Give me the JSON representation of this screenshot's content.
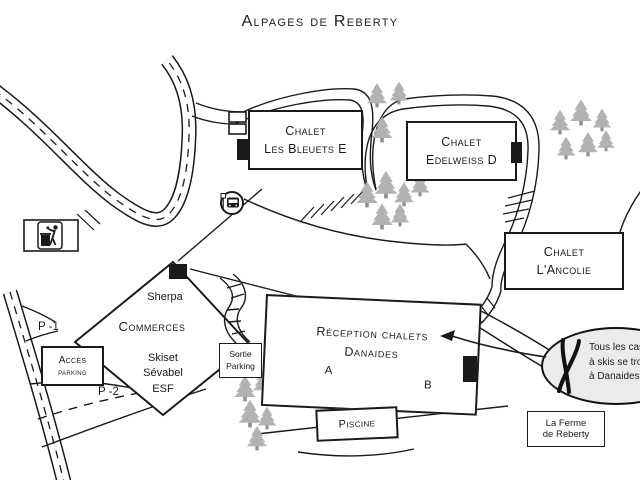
{
  "title": "Alpages de Reberty",
  "chalets": {
    "bleuets": {
      "line1": "Chalet",
      "line2": "Les Bleuets E"
    },
    "edelweiss": {
      "line1": "Chalet",
      "line2": "Edelweiss D"
    },
    "ancolie": {
      "line1": "Chalet",
      "line2": "L'Ancolie"
    }
  },
  "commerces": {
    "store": "Sherpa",
    "label": "Commerces",
    "services": [
      "Skiset",
      "Sévabel",
      "ESF"
    ]
  },
  "reception": {
    "line1": "Réception chalets",
    "line2": "Danaides",
    "unit_a": "A",
    "unit_b": "B"
  },
  "parking": {
    "p1": "P -1",
    "p2": "P -2",
    "access": {
      "line1": "Accès",
      "line2": "parking"
    },
    "exit": {
      "line1": "Sortie",
      "line2": "Parking"
    }
  },
  "pool": {
    "label": "Piscine"
  },
  "farm": {
    "line1": "La Ferme",
    "line2": "de Reberty"
  },
  "balloon": {
    "line1": "Tous les casie",
    "line2": "à skis se trouv",
    "line3": "à Danaides"
  },
  "icons": {
    "bus_stop": "bus-stop",
    "trash": "waste-disposal",
    "skis": "crossed-skis",
    "tree": "pine-tree"
  },
  "colors": {
    "ink": "#1a1a1a",
    "tree": "#b2b2b2",
    "tree_trunk": "#8e8e8e",
    "balloon_fill": "#ebebeb",
    "paper": "#ffffff"
  }
}
